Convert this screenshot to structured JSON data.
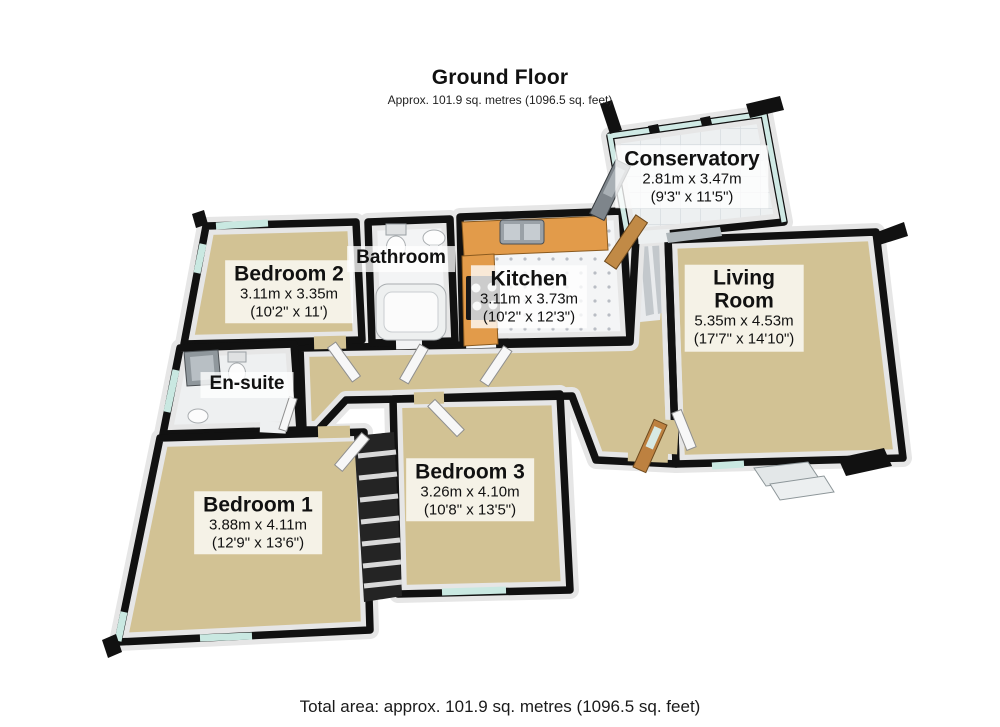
{
  "header": {
    "title": "Ground Floor",
    "subtitle": "Approx. 101.9 sq. metres (1096.5 sq. feet)"
  },
  "footer": {
    "total_area": "Total area: approx. 101.9 sq. metres (1096.5 sq. feet)"
  },
  "rooms": {
    "bedroom2": {
      "name": "Bedroom 2",
      "metric": "3.11m x 3.35m",
      "imperial": "(10'2\" x 11')"
    },
    "bathroom": {
      "name": "Bathroom"
    },
    "kitchen": {
      "name": "Kitchen",
      "metric": "3.11m x 3.73m",
      "imperial": "(10'2\" x 12'3\")"
    },
    "conservatory": {
      "name": "Conservatory",
      "metric": "2.81m x 3.47m",
      "imperial": "(9'3\" x 11'5\")"
    },
    "living_room": {
      "name": "Living Room",
      "metric": "5.35m x 4.53m",
      "imperial": "(17'7\" x 14'10\")"
    },
    "ensuite": {
      "name": "En-suite"
    },
    "bedroom1": {
      "name": "Bedroom 1",
      "metric": "3.88m x 4.11m",
      "imperial": "(12'9\" x 13'6\")"
    },
    "bedroom3": {
      "name": "Bedroom 3",
      "metric": "3.26m x 4.10m",
      "imperial": "(10'8\" x 13'5\")"
    }
  },
  "colors": {
    "carpet": "#d2c294",
    "tile": "#f4f5f6",
    "wall": "#111111",
    "wall_face": "#e6e6e6",
    "glass": "#c9e8e1",
    "wood": "#c18a46",
    "counter": "#e29b4a",
    "label_bg": "rgba(255,255,255,0.78)",
    "text": "#111111"
  }
}
